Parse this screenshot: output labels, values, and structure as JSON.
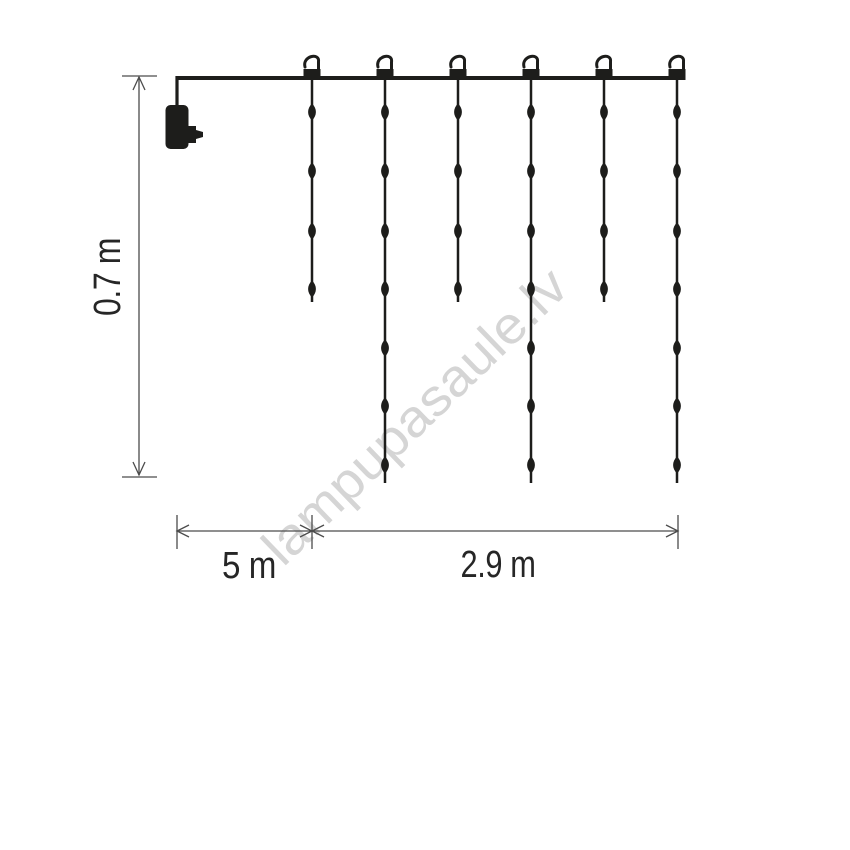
{
  "diagram": {
    "subject": "icicle-light-curtain-dimension-drawing",
    "colors": {
      "ink": "#1d1d1b",
      "dimension": "#4c4c4c",
      "label": "#262626",
      "watermark": "#d5d5d5",
      "background": "#ffffff"
    },
    "watermark": {
      "text": "lampupasaule.lv"
    },
    "dimensions": {
      "height": {
        "label": "0.7 m"
      },
      "lead": {
        "label": "5 m"
      },
      "span": {
        "label": "2.9 m"
      }
    },
    "lights": {
      "hook_count": 6,
      "wire": {
        "x1": 177,
        "x2": 684,
        "y": 78
      },
      "strands": [
        {
          "x": 312,
          "beads": [
            112,
            171,
            231,
            289
          ],
          "end": 302
        },
        {
          "x": 385,
          "beads": [
            112,
            171,
            231,
            289,
            348,
            406,
            465
          ],
          "end": 483
        },
        {
          "x": 458,
          "beads": [
            112,
            171,
            231,
            289
          ],
          "end": 302
        },
        {
          "x": 531,
          "beads": [
            112,
            171,
            231,
            289,
            348,
            406,
            465
          ],
          "end": 483
        },
        {
          "x": 604,
          "beads": [
            112,
            171,
            231,
            289
          ],
          "end": 302
        },
        {
          "x": 677,
          "beads": [
            112,
            171,
            231,
            289,
            348,
            406,
            465
          ],
          "end": 483
        }
      ]
    }
  }
}
